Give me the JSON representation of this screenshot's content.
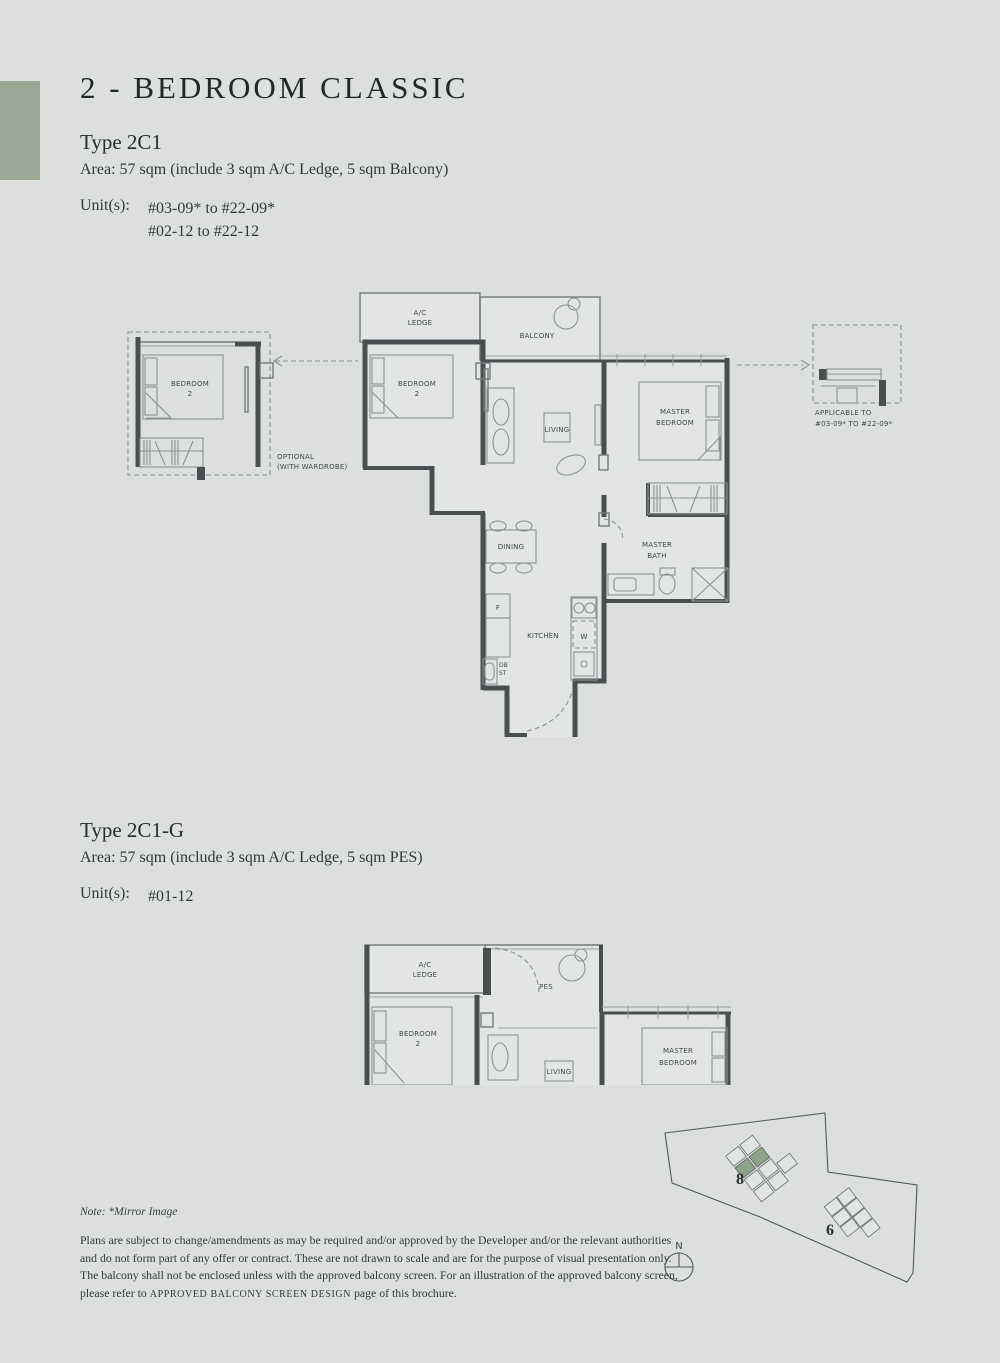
{
  "header": {
    "title": "2 - BEDROOM CLASSIC",
    "accent_color": "#9aa794"
  },
  "type_2c1": {
    "name": "Type 2C1",
    "area": "Area: 57 sqm (include 3 sqm A/C Ledge, 5 sqm Balcony)",
    "units_label": "Unit(s):",
    "unit_1": "#03-09* to #22-09*",
    "unit_2": "#02-12 to #22-12"
  },
  "type_2c1g": {
    "name": "Type 2C1-G",
    "area": "Area: 57 sqm (include 3 sqm A/C Ledge, 5 sqm PES)",
    "units_label": "Unit(s):",
    "unit_1": "#01-12"
  },
  "plan1": {
    "labels": {
      "ac_1": "A/C",
      "ac_2": "LEDGE",
      "balcony": "BALCONY",
      "bedroom2_1": "BEDROOM",
      "bedroom2_2": "2",
      "opt_bedroom2_1": "BEDROOM",
      "opt_bedroom2_2": "2",
      "living": "LIVING",
      "master_1": "MASTER",
      "master_2": "BEDROOM",
      "bath_1": "MASTER",
      "bath_2": "BATH",
      "dining": "DINING",
      "kitchen": "KITCHEN",
      "fridge": "F",
      "washer": "W",
      "db": "DB",
      "st": "ST",
      "optional_1": "OPTIONAL",
      "optional_2": "(WITH WARDROBE)",
      "applicable_1": "APPLICABLE TO",
      "applicable_2": "#03-09* TO #22-09*"
    },
    "wall_color": "#4b4e50"
  },
  "plan2": {
    "labels": {
      "ac_1": "A/C",
      "ac_2": "LEDGE",
      "pes": "PES",
      "bedroom2_1": "BEDROOM",
      "bedroom2_2": "2",
      "living": "LIVING",
      "master_1": "MASTER",
      "master_2": "BEDROOM"
    }
  },
  "site_plan": {
    "block_8": "8",
    "block_6": "6",
    "north": "N",
    "highlight_color": "#8da287"
  },
  "footer": {
    "note": "Note: *Mirror Image",
    "line1": "Plans are subject to change/amendments as may be required and/or approved by the Developer and/or the relevant authorities",
    "line2": "and do not form part of any offer or contract. These are not drawn to scale and are for the purpose of visual presentation only.",
    "line3": "The balcony shall not be enclosed unless with the approved balcony screen. For an illustration of the approved balcony screen,",
    "line4_pre": "please refer to ",
    "line4_caps": "APPROVED BALCONY SCREEN DESIGN",
    "line4_post": " page of this brochure."
  }
}
